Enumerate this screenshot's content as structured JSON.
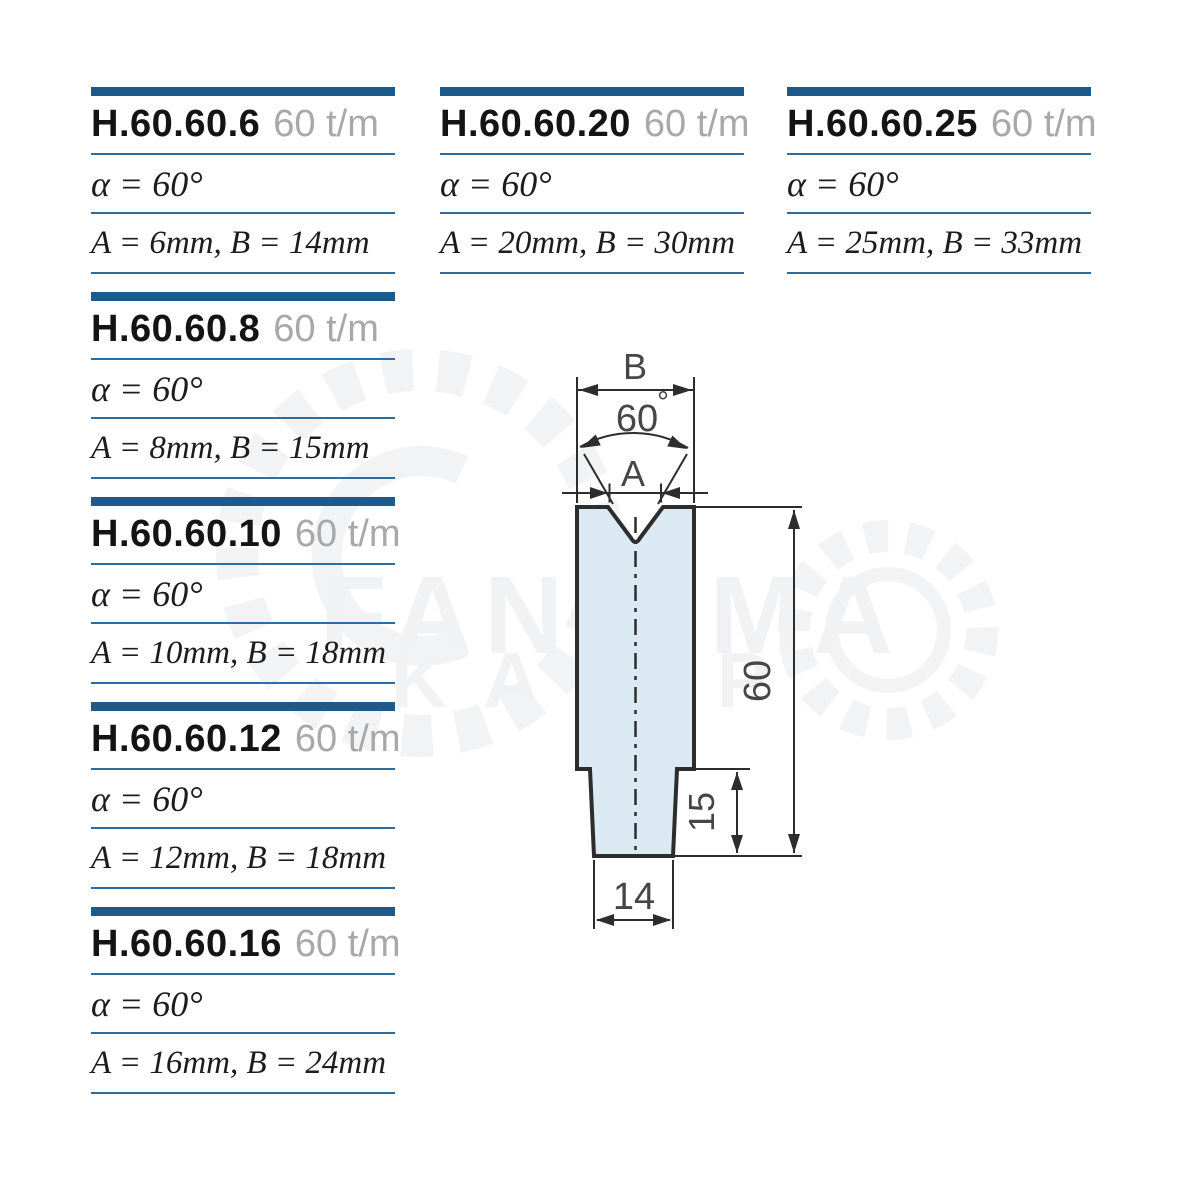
{
  "colors": {
    "accent_bar": "#1d5a8c",
    "rule_line": "#2e6da2",
    "code_black": "#141414",
    "tonnage_gray": "#a8a8a8",
    "drawing_outline": "#2d2d2d",
    "drawing_fill": "#dbe9f2",
    "dim_text": "#464646",
    "watermark": "#f1f2f4"
  },
  "columns": [
    {
      "entries": [
        {
          "code": "H.60.60.6",
          "tonnage": "60 t/m",
          "alpha": "α = 60°",
          "dims": "A = 6mm, B = 14mm"
        },
        {
          "code": "H.60.60.8",
          "tonnage": "60 t/m",
          "alpha": "α = 60°",
          "dims": "A = 8mm, B = 15mm"
        },
        {
          "code": "H.60.60.10",
          "tonnage": "60 t/m",
          "alpha": "α = 60°",
          "dims": "A = 10mm, B = 18mm"
        },
        {
          "code": "H.60.60.12",
          "tonnage": "60 t/m",
          "alpha": "α = 60°",
          "dims": "A = 12mm, B = 18mm"
        },
        {
          "code": "H.60.60.16",
          "tonnage": "60 t/m",
          "alpha": "α = 60°",
          "dims": "A = 16mm, B = 24mm"
        }
      ]
    },
    {
      "entries": [
        {
          "code": "H.60.60.20",
          "tonnage": "60 t/m",
          "alpha": "α = 60°",
          "dims": "A = 20mm, B = 30mm"
        }
      ]
    },
    {
      "entries": [
        {
          "code": "H.60.60.25",
          "tonnage": "60 t/m",
          "alpha": "α = 60°",
          "dims": "A = 25mm, B = 33mm"
        }
      ]
    }
  ],
  "drawing": {
    "b_label": "B",
    "angle_value": "60",
    "degree_mark": "°",
    "a_label": "A",
    "height_label": "60",
    "shoulder_label": "15",
    "base_width_label": "14"
  },
  "watermark": {
    "line1": "FANIRMA",
    "line2": "KALIP"
  }
}
